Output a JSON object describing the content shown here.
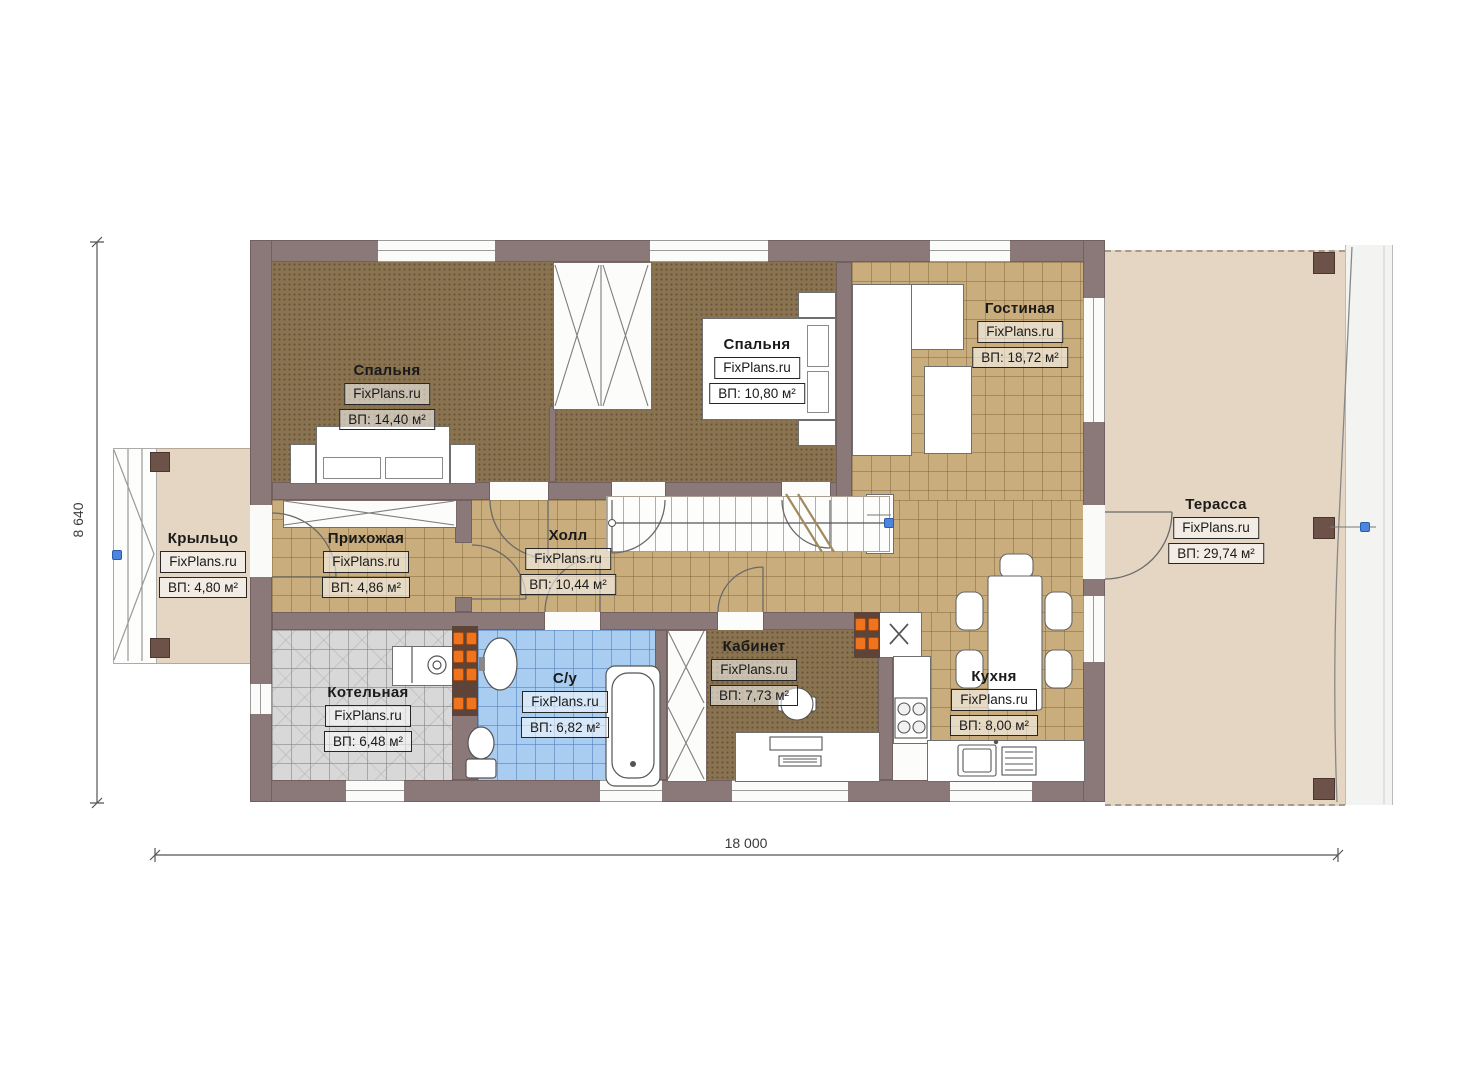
{
  "plan": {
    "watermark": "FixPlans.ru",
    "dimensions": {
      "width_label": "18 000",
      "height_label": "8 640"
    },
    "rooms": [
      {
        "name": "Спальня",
        "area": "ВП: 14,40 м²",
        "floor": "carpet"
      },
      {
        "name": "Спальня",
        "area": "ВП: 10,80 м²",
        "floor": "carpet"
      },
      {
        "name": "Гостиная",
        "area": "ВП: 18,72 м²",
        "floor": "tile"
      },
      {
        "name": "Терасса",
        "area": "ВП: 29,74 м²",
        "floor": "deck"
      },
      {
        "name": "Крыльцо",
        "area": "ВП: 4,80 м²",
        "floor": "deck"
      },
      {
        "name": "Прихожая",
        "area": "ВП: 4,86 м²",
        "floor": "tile"
      },
      {
        "name": "Холл",
        "area": "ВП: 10,44 м²",
        "floor": "tile"
      },
      {
        "name": "Котельная",
        "area": "ВП: 6,48 м²",
        "floor": "boiler-tile"
      },
      {
        "name": "С/у",
        "area": "ВП: 6,82 м²",
        "floor": "bath-tile"
      },
      {
        "name": "Кабинет",
        "area": "ВП: 7,73 м²",
        "floor": "carpet"
      },
      {
        "name": "Кухня",
        "area": "ВП: 8,00 м²",
        "floor": "tile"
      }
    ],
    "colors": {
      "wall": "#8b7878",
      "post": "#6d524a",
      "carpet": "#8a7350",
      "tile": "#c9ad7c",
      "bath_tile": "#a8cdf0",
      "boiler_tile": "#d8d8d8",
      "deck": "#e4d6c3",
      "radiator": "#f0731d",
      "marker": "#4d84dd"
    }
  }
}
